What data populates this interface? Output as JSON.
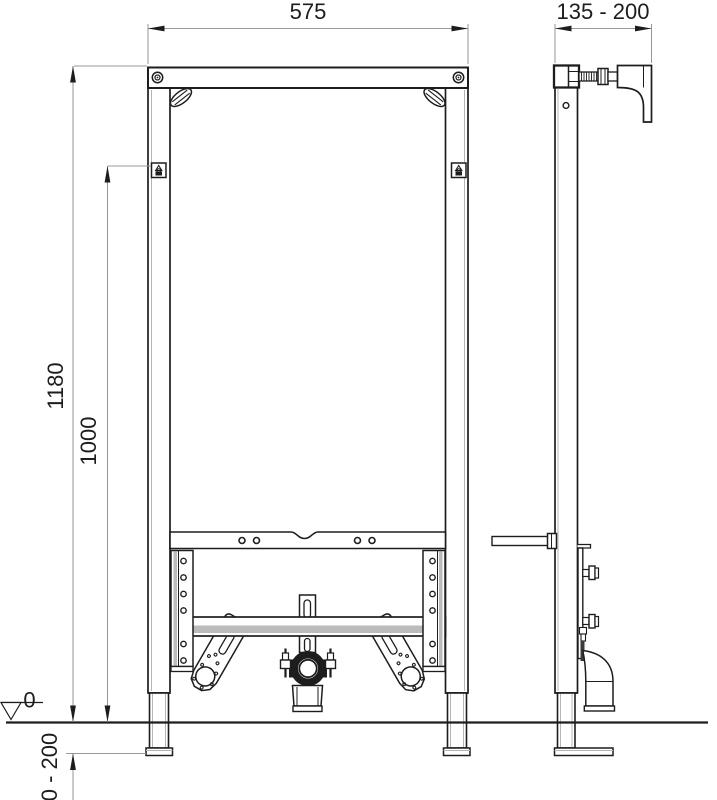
{
  "drawing": {
    "dimensions": {
      "frame_width": "575",
      "wall_distance_range": "135 - 200",
      "frame_height": "1180",
      "fixing_height": "1000",
      "floor_level": "0",
      "foot_adjustment_range": "0 - 200"
    },
    "colors": {
      "line": "#1d1d1d",
      "dim": "#999999",
      "shade": "#8d8d8d",
      "bg": "#ffffff"
    }
  }
}
